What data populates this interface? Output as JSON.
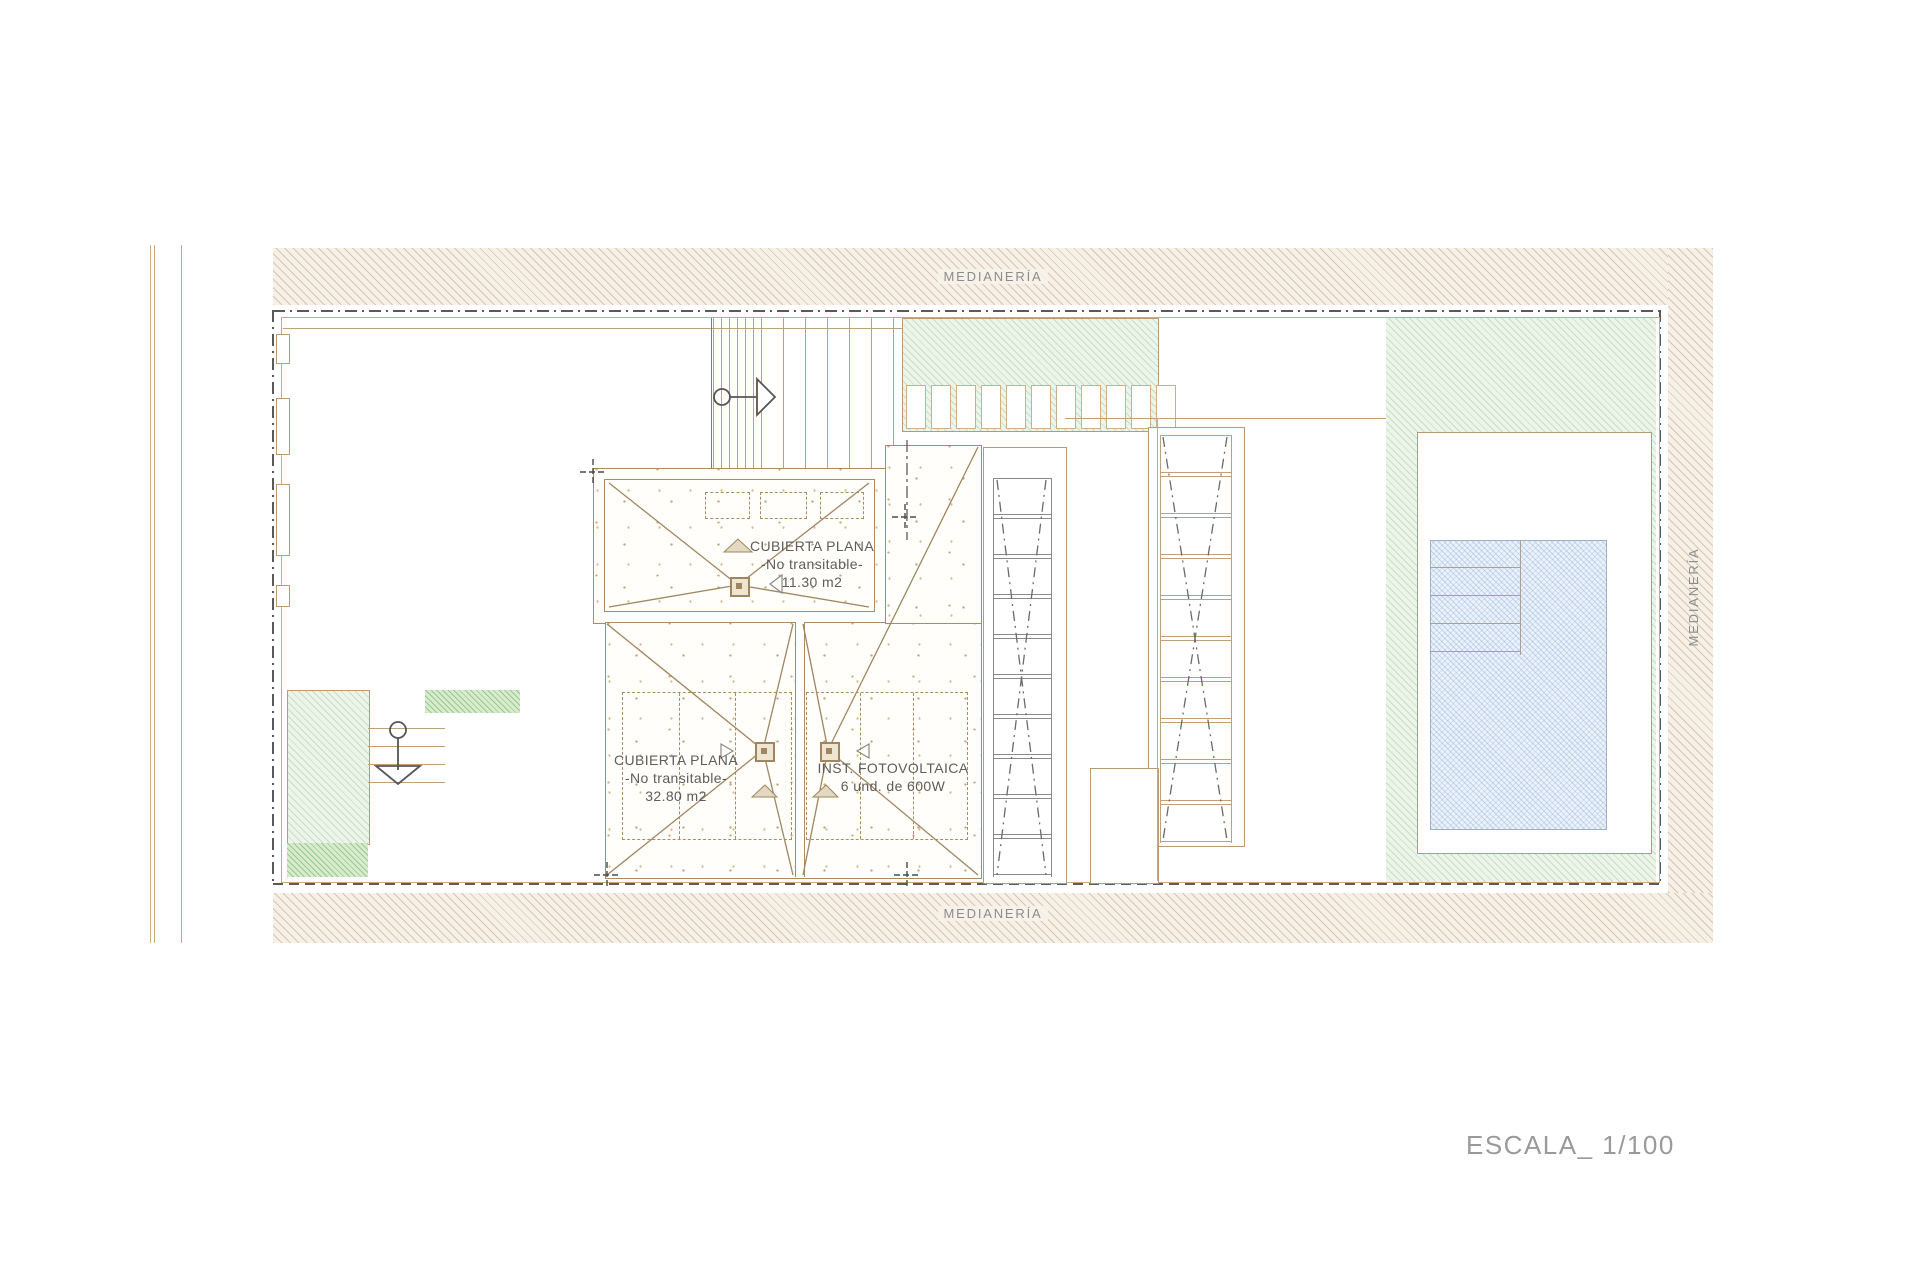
{
  "labels": {
    "party_wall_top": "MEDIANERÍA",
    "party_wall_bottom": "MEDIANERÍA",
    "party_wall_right": "MEDIANERÍA",
    "scale": "ESCALA_ 1/100"
  },
  "roofs": {
    "upper": {
      "name": "CUBIERTA PLANA",
      "condition": "-No transitable-",
      "area": "11.30 m2"
    },
    "lower_left": {
      "name": "CUBIERTA PLANA",
      "condition": "-No transitable-",
      "area": "32.80 m2"
    },
    "lower_right": {
      "name": "INST. FOTOVOLTAICA",
      "detail": "6 und.  de 600W"
    }
  },
  "colors": {
    "line_tan": "#c0a078",
    "line_dark": "#5a5a5a",
    "hatch_band": "#f6f0e7",
    "green_light": "#edf5ea",
    "green_dark": "#d8eccd",
    "pool_blue": "#eaf2fb",
    "text_gray": "#8c8c8c"
  }
}
